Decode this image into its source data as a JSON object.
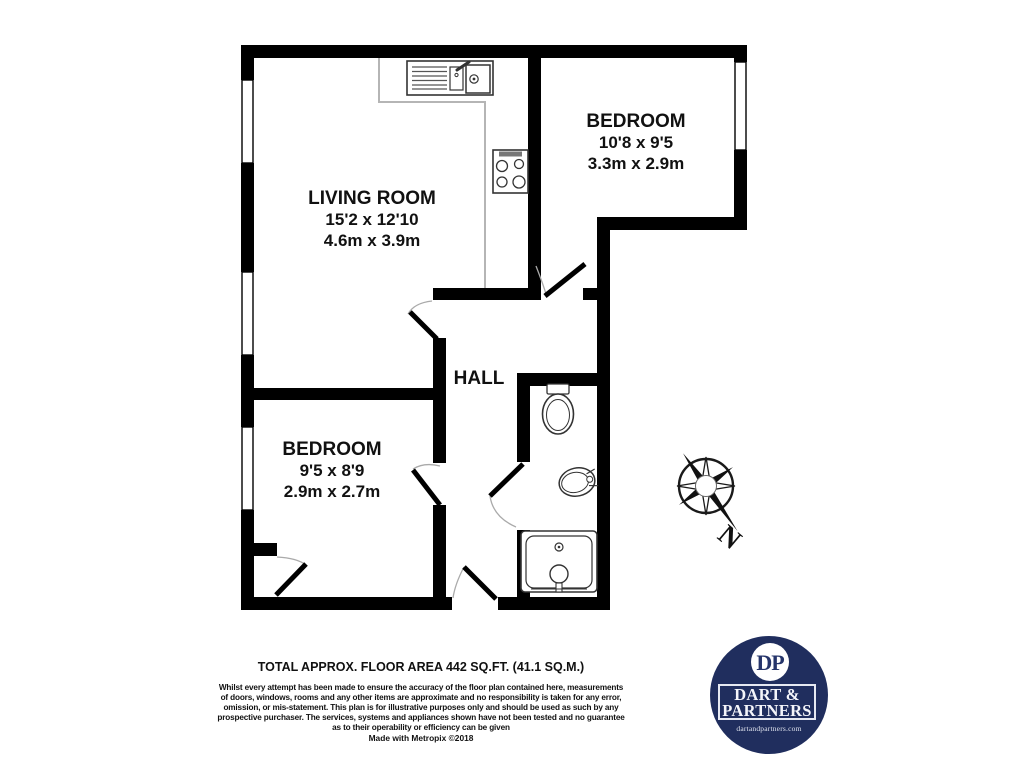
{
  "plan": {
    "rooms": [
      {
        "name": "LIVING ROOM",
        "imperial": "15'2 x 12'10",
        "metric": "4.6m x 3.9m"
      },
      {
        "name": "BEDROOM",
        "imperial": "10'8 x 9'5",
        "metric": "3.3m x 2.9m"
      },
      {
        "name": "BEDROOM",
        "imperial": "9'5 x 8'9",
        "metric": "2.9m x 2.7m"
      },
      {
        "name": "HALL"
      }
    ],
    "compass": {
      "north_label": "N"
    }
  },
  "footer": {
    "area_title": "TOTAL APPROX. FLOOR AREA 442 SQ.FT. (41.1 SQ.M.)",
    "disclaimer_lines": [
      "Whilst every attempt has been made to ensure the accuracy of the floor plan contained here, measurements",
      "of doors, windows, rooms and any other items are approximate and no responsibility is taken for any error,",
      "omission, or mis-statement. This plan is for illustrative purposes only and should be used as such by any",
      "prospective purchaser. The services, systems and appliances shown have not been tested and no guarantee",
      "as to their operability or efficiency can be given"
    ],
    "credit": "Made with Metropix ©2018"
  },
  "logo": {
    "monogram": "DP",
    "name_line1": "DART &",
    "name_line2": "PARTNERS",
    "website": "dartandpartners.com"
  },
  "colors": {
    "wall": "#000000",
    "counter_line": "#b5b5b5",
    "logo_navy": "#202e5e",
    "background": "#ffffff"
  }
}
